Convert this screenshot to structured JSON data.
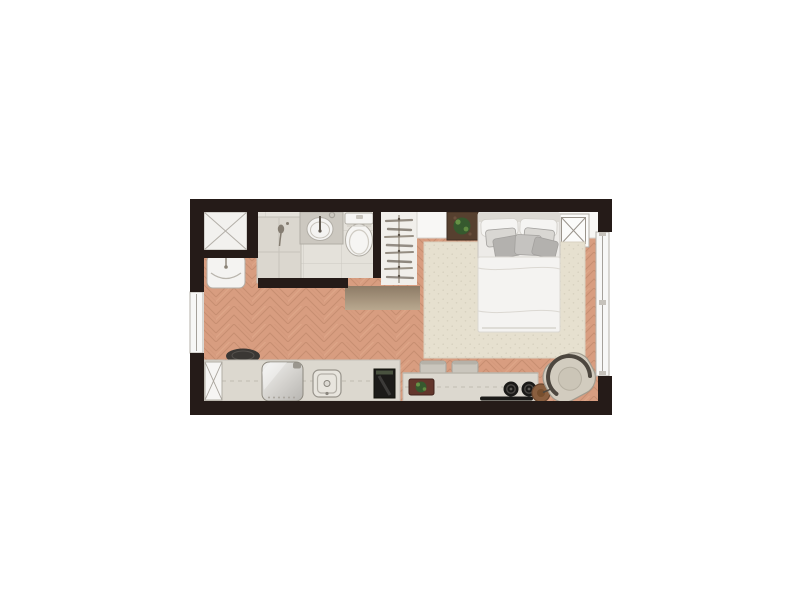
{
  "page": {
    "background": "#ffffff",
    "kind": "studio-apartment-floor-plan"
  },
  "colors": {
    "wall": "#251b18",
    "wood_base": "#d89d80",
    "wood_line": "#c08669",
    "tile": "#e4e1da",
    "tile_line": "#cdc9c2",
    "shower_box": "#f2f1ee",
    "fixture_white": "#f6f5f3",
    "cabinet": "#dbd7cf",
    "vanity": "#ccc8c0",
    "basin": "#f4f3f1",
    "closet_bg": "#f1efeb",
    "hanger": "#7d7468",
    "rod": "#9a9083",
    "shelf": "#f8f7f5",
    "plant_pot_shelf": "#56402f",
    "plant_pot_counter": "#63362c",
    "plant_green": "#36592e",
    "plant_green_light": "#6f9c4a",
    "ac_box": "#fbfbfa",
    "rug": "#e6e0cf",
    "rug_dot": "#d7d1bf",
    "bed": "#edebe8",
    "headboard": "#dcd9d3",
    "pillow": "#f5f4f2",
    "cushion_light": "#d9d7d3",
    "cushion_mid": "#c5c3c0",
    "cushion_dark": "#b3b1ae",
    "duvet": "#f4f3f1",
    "door_top": "#8d7b66",
    "door_bottom": "#b9a88f",
    "counter": "#dcd8cf",
    "shaft": "#f6f5f3",
    "stool_dark": "#3a3734",
    "stool_light": "#cac6bd",
    "stool_band": "#b5b1a8",
    "metal_light": "#f2f2f1",
    "metal_mid": "#d6d4d0",
    "metal_dark": "#b7b5b1",
    "fridge_handle": "#9a968e",
    "sink_outer": "#e8e5de",
    "sink_inner": "#dcd9d2",
    "drain": "#8a867e",
    "appliance": "#1c1b19",
    "appliance_top": "#49523f",
    "burner": "#1a1917",
    "burner_ring": "#4a4744",
    "strip": "#1b1a18",
    "chair": "#d2ccbf",
    "chair_outline": "#4d473f",
    "chair_cushion": "#cbc5b7",
    "table": "#8a5f3f",
    "table_inner": "#774f2e",
    "window": "#f7f7f6",
    "window_line": "#a5a19b",
    "mullion": "#c6c2bb",
    "machine": "#f4f3f1",
    "wand": "#857d72"
  },
  "rooms": [
    {
      "name": "bathroom"
    },
    {
      "name": "closet"
    },
    {
      "name": "sleeping-area"
    },
    {
      "name": "kitchen-living"
    }
  ],
  "items": [
    "shower-box",
    "washing-machine",
    "bathroom-cabinet",
    "vanity-sink",
    "toilet",
    "wardrobe-hangers",
    "wall-shelf",
    "potted-plant-shelf",
    "ac-unit-box",
    "double-bed",
    "area-rug",
    "entry-door-panel",
    "left-window",
    "right-window",
    "kitchen-counter",
    "service-shaft",
    "bar-stool-dark",
    "refrigerator",
    "kitchen-sink",
    "built-in-appliance",
    "potted-plant-counter",
    "bar-stool-1",
    "bar-stool-2",
    "cooktop-burners",
    "counter-ledge",
    "side-table",
    "armchair"
  ]
}
